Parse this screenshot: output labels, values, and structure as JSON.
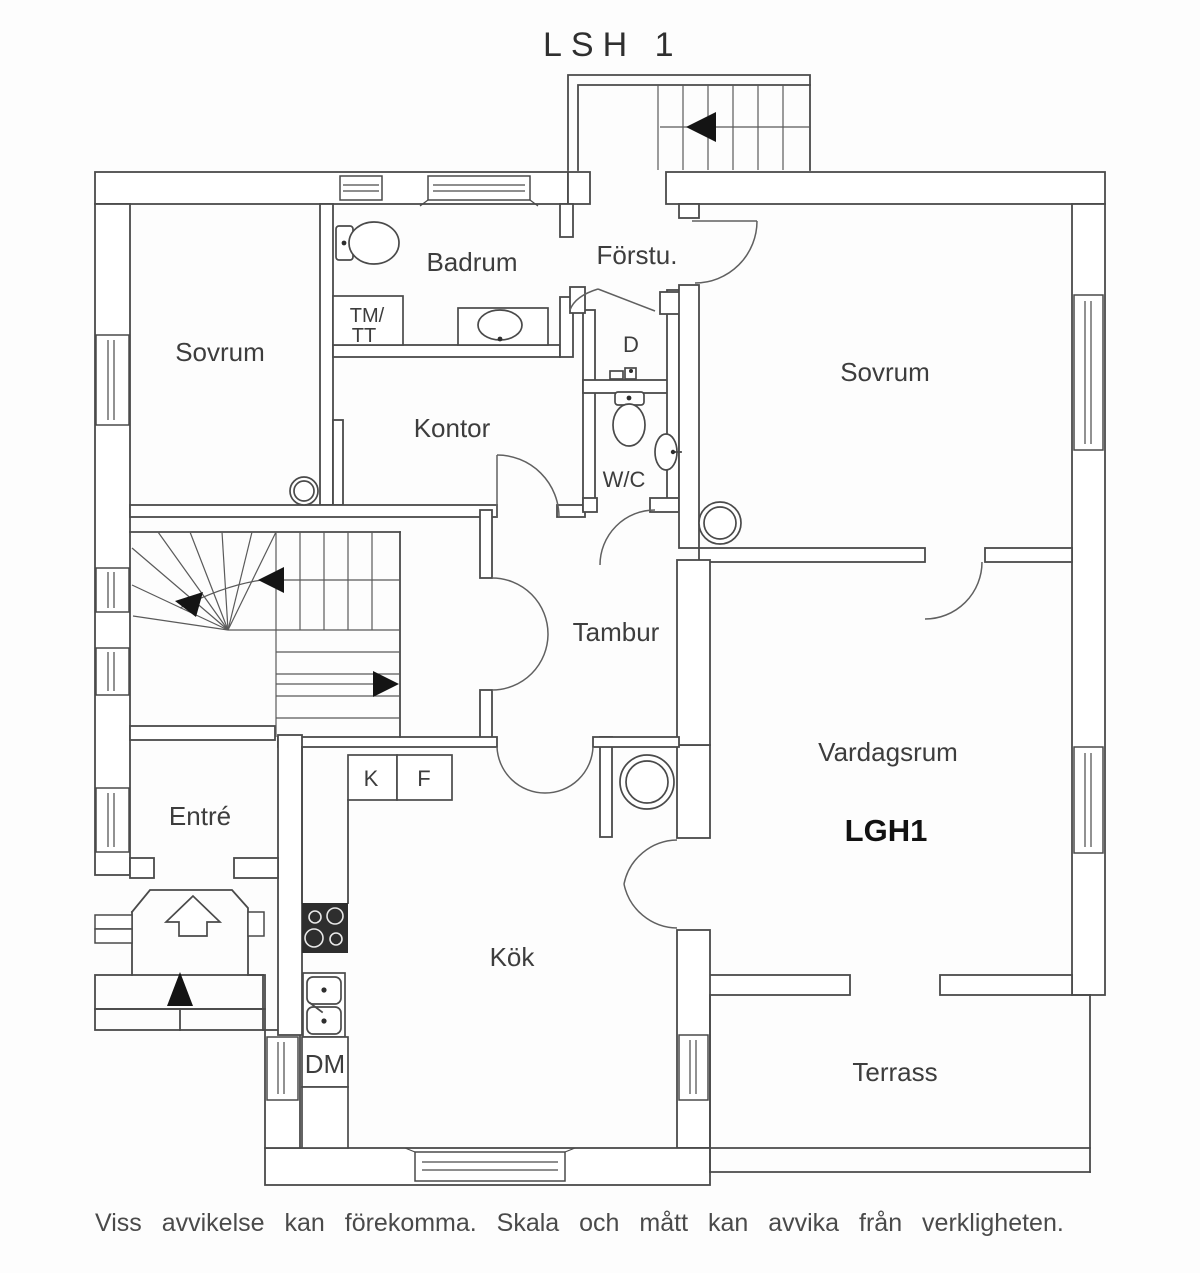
{
  "title": "LSH 1",
  "footer": {
    "disclaimer": "Viss avvikelse kan förekomma. Skala och mått kan avvika från verkligheten."
  },
  "floorplan": {
    "apartment_label": "LGH1",
    "rooms": [
      {
        "id": "sovrum-left",
        "label": "Sovrum"
      },
      {
        "id": "badrum",
        "label": "Badrum"
      },
      {
        "id": "forstu",
        "label": "Förstu."
      },
      {
        "id": "kontor",
        "label": "Kontor"
      },
      {
        "id": "sovrum-right",
        "label": "Sovrum"
      },
      {
        "id": "tambur",
        "label": "Tambur"
      },
      {
        "id": "vardagsrum",
        "label": "Vardagsrum"
      },
      {
        "id": "entre",
        "label": "Entré"
      },
      {
        "id": "kok",
        "label": "Kök"
      },
      {
        "id": "terrass",
        "label": "Terrass"
      },
      {
        "id": "wc",
        "label": "W/C"
      },
      {
        "id": "d-closet",
        "label": "D"
      }
    ],
    "closet_labels": {
      "tm_tt_line1": "TM/",
      "tm_tt_line2": "TT",
      "k": "K",
      "f": "F",
      "dm": "DM"
    },
    "fixture_icons": [
      "toilet-icon",
      "toilet-icon",
      "bathroom-sink-icon",
      "wc-sink-icon",
      "kitchen-sink-icon",
      "stove-icon",
      "chimney-icon",
      "chimney-icon",
      "chimney-icon",
      "stairs-icon",
      "stairs-icon",
      "direction-arrow-icon",
      "entrance-arrow-icon"
    ],
    "colors": {
      "line": "#4a4a4a",
      "text": "#3d3d3d",
      "stove": "#2e2e2e",
      "arrow": "#141414",
      "background": "#fdfdfd"
    }
  }
}
